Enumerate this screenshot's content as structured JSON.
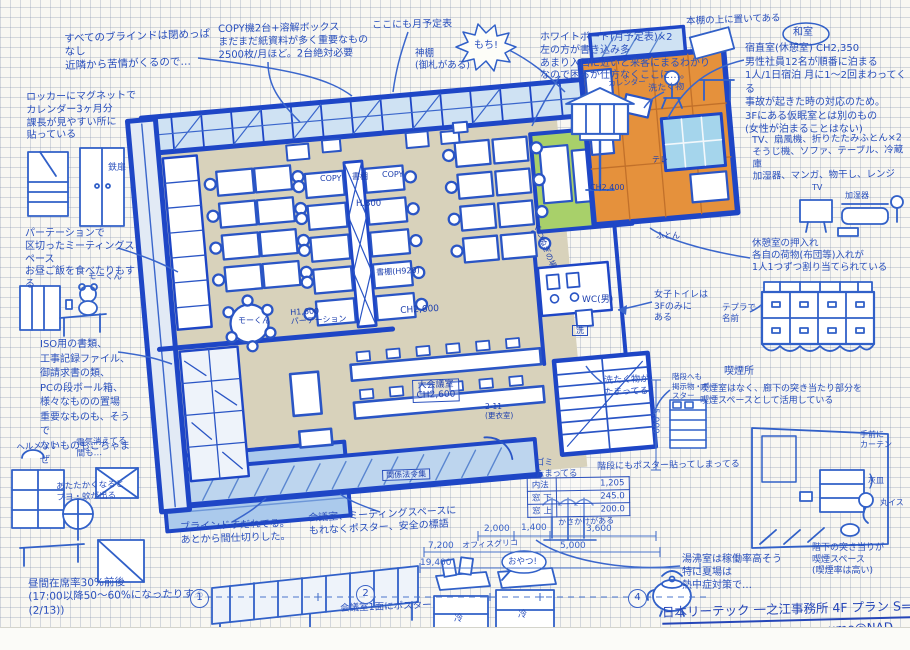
{
  "colors": {
    "ink": "#2a50bd",
    "wall": "#1e46c6",
    "floor": "#d8d2bb",
    "window_wash": "#cfe2f3",
    "veranda": "#bdd5ee",
    "orange_room": "#e5913c",
    "green_room": "#a8d06a",
    "cyan_window": "#a5d5ec"
  },
  "sheet": {
    "title": "日本リーテック 一之江事務所 4F プラン S=1/100",
    "signature": "ume@NAD.",
    "axis_markers": [
      "1",
      "2",
      "4"
    ]
  },
  "notes": {
    "blinds": "すべてのブラインドは閉めっぱなし\n近隣から苦情がくるので…",
    "locker_calendar": "ロッカーにマグネットで\nカレンダー3ヶ月分\n課長が見やすい所に\n貼っている",
    "steel_door": "鉄扉",
    "copy_machines": "COPY機2台+溶解ボックス\nまだまだ紙資料が多く重要なもの\n2500枚/月ほど。2台絶対必要",
    "monthly_here": "ここにも月予定表",
    "kamidana": "神棚\n(御札がある)",
    "mochi": "もち!",
    "whiteboard": "ホワイトボード(月予定表)×2\n左の方が書き込み多\nあまり入口に近いと来客にまるわかり\nなので困るが仕方なくここに…。",
    "on_bookshelf": "本棚の上に置いてある",
    "washitsu": "和室",
    "night_duty": "宿直室(休憩室) CH2,350\n男性社員12名が順番に泊まる\n1人/1日宿泊 月に1〜2回まわってくる\n事故が起きた時の対応のため。\n3Fにある仮眠室とは別のもの\n(女性が泊まることはない)",
    "duty_items": "TV、扇風機、折りたたみふとん×2\nそうじ機、ソファ、テーブル、冷蔵庫\n加湿器、マンガ、物干し、レンジ",
    "laundry": "洗たく物",
    "calendar": "カレンダー",
    "tv": "TV",
    "humidifier": "加湿器",
    "closet": "休憩室の押入れ\n各自の荷物(布団等)入れが\n1人1つずつ割り当てられている",
    "tepra": "テプラで\n名前",
    "smoking_spot": "喫煙所",
    "smoking_note": "喫煙室はなく、廊下の突き当たり部分を\n喫煙スペースとして活用している",
    "curtain": "手前に\nカーテン",
    "ashtray": "灰皿",
    "stool": "丸イス",
    "kettle_room": "湯沸室は稼働率高そう\n特に夏場は\n熱中症対策で…",
    "downstairs_smoking": "階下の突き当りが\n喫煙スペース\n(喫煙率は高い)",
    "stairs_poster": "階段にもポスター貼ってしまってる",
    "stairs_notice": "階段へも\n掲示物・ポスター",
    "laundry_piled": "洗たく物が\nたまってる",
    "womens_wc": "女子トイレは\n3Fのみに\nある",
    "meeting_corner": "パーテーションで\n区切ったミーティングスペース\nお昼ご飯を食べたりもする",
    "mo_kun": "モーくん",
    "iso_storage": "ISO用の書類、\n工事記録ファイル、\n御請求書の類、\nPCの段ボール箱、\n様々なものの置場\n重要なものも、そうで\nないものもごちゃまぜ",
    "helmet": "ヘルメット",
    "lights_off": "電気消えてる\n間も…",
    "warm_season": "あたたかくなると\nブヨ・蚊が出る",
    "occupancy": "昼間在席率30%前後\n(17:00以降50〜60%になったりする(2/13))",
    "sudare": "ブラインドすだれてる。\nあとから間仕切りした。",
    "posters_everywhere": "会議室、ミーティングスペースに\nもれなくポスター、安全の標語",
    "poster_wall": "会議室1面にポスター",
    "office_glico": "オフィスグリコ",
    "snack": "おやつ!",
    "fridge": "冷",
    "umbrella": "かさかけがある",
    "trash": "ゴミ\nたまってる"
  },
  "plan_labels": {
    "copy_a": "COPY",
    "shelf_top": "書棚",
    "copy_b": "COPY",
    "h800": "H.800",
    "shelf920": "書棚(H920)",
    "ch2600": "CH2,600",
    "h1600": "H1,600\nパーテーション",
    "mo_kun2": "モーくん",
    "ch2400": "CH2,400",
    "futon": "ふとん",
    "tv_wall": "テレ",
    "shoes": "くつぬぎの場",
    "wc": "WC(男)",
    "laundry_machine": "洗",
    "main_meeting": "大会議室\nCH2,600",
    "locker_room": "2-11\n(更衣室)",
    "laws": "関係法令集"
  },
  "dimensions": {
    "w2000": "2,000",
    "w1400": "1,400",
    "w3600": "3,600",
    "w5000": "5,000",
    "w7200": "7,200",
    "w19400": "19,400",
    "v5000": "5,000"
  },
  "spec_table": {
    "rows": [
      {
        "label": "内法",
        "value": "1,205"
      },
      {
        "label": "窓 下",
        "value": "245.0"
      },
      {
        "label": "窓 上",
        "value": "200.0"
      }
    ]
  }
}
